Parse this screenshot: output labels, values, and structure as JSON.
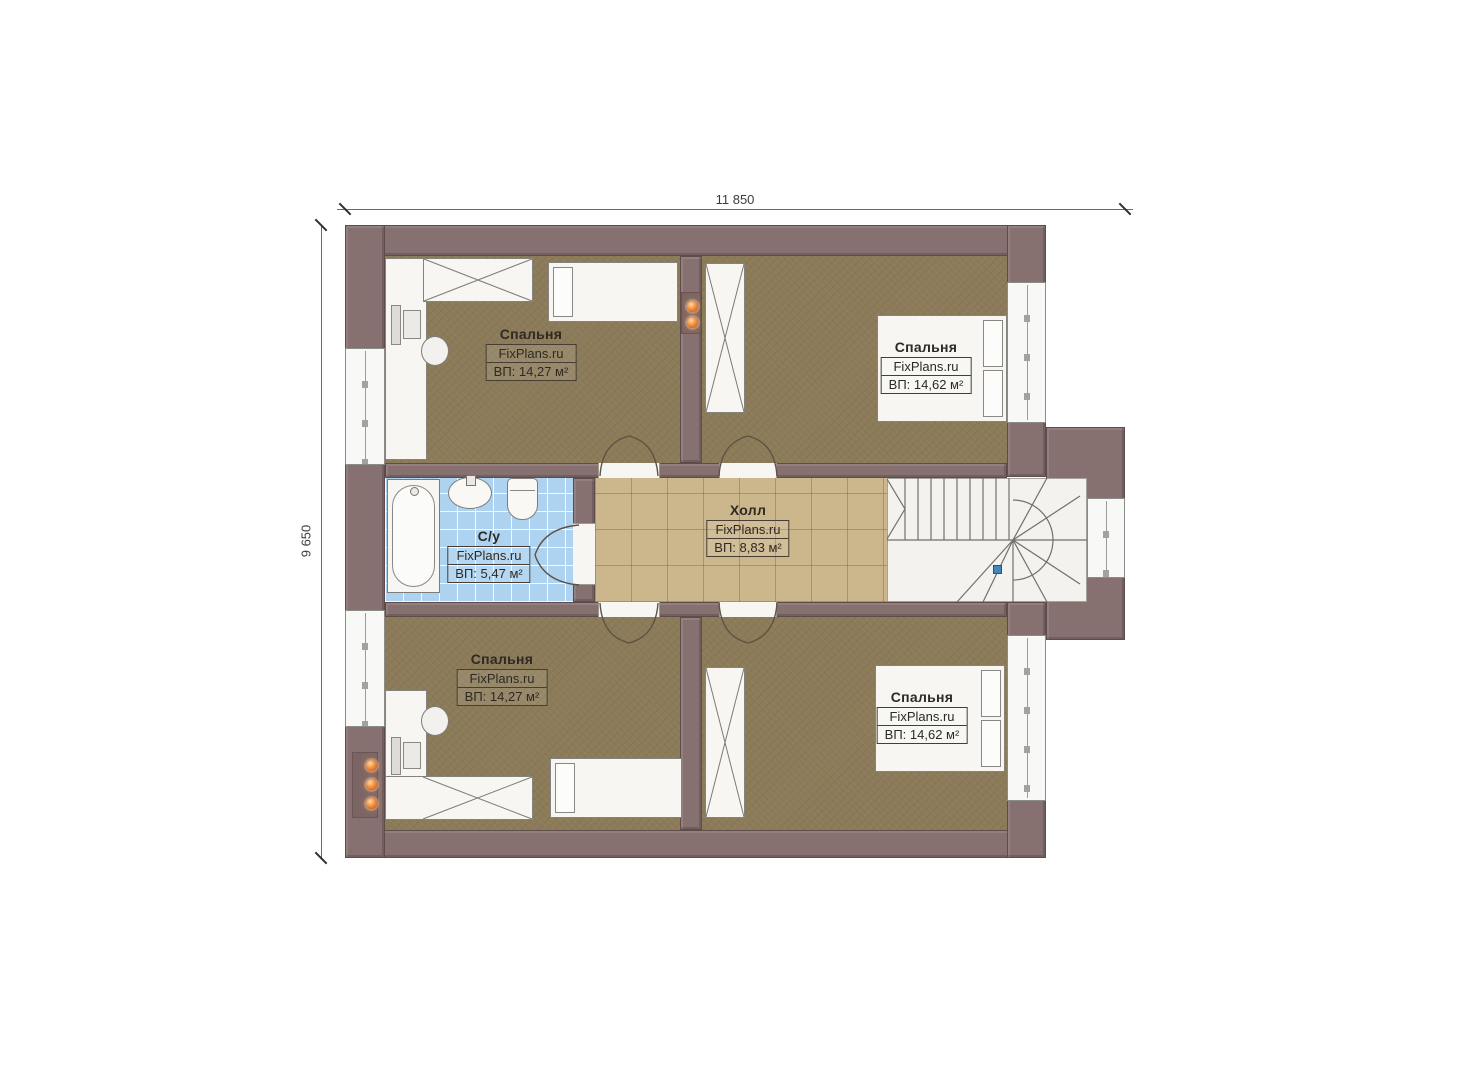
{
  "plan": {
    "title_dimensions": {
      "horizontal": "11 850",
      "vertical": "9 650"
    },
    "rooms": [
      {
        "key": "bedroom-top-left",
        "name": "Спальня",
        "brand": "FixPlans.ru",
        "area": "ВП: 14,27 м²"
      },
      {
        "key": "bedroom-top-right",
        "name": "Спальня",
        "brand": "FixPlans.ru",
        "area": "ВП: 14,62 м²"
      },
      {
        "key": "bathroom",
        "name": "С/у",
        "brand": "FixPlans.ru",
        "area": "ВП: 5,47 м²"
      },
      {
        "key": "hall",
        "name": "Холл",
        "brand": "FixPlans.ru",
        "area": "ВП: 8,83 м²"
      },
      {
        "key": "bedroom-bottom-left",
        "name": "Спальня",
        "brand": "FixPlans.ru",
        "area": "ВП: 14,27 м²"
      },
      {
        "key": "bedroom-bottom-right",
        "name": "Спальня",
        "brand": "FixPlans.ru",
        "area": "ВП: 14,62 м²"
      }
    ],
    "colors": {
      "wall": "#877170",
      "bedroom_floor": "#8c7b59",
      "hall_floor": "#ccb68c",
      "bath_floor": "#aed3f1",
      "stairs_floor": "#f3f2ef",
      "wall_light": "#f08030",
      "level_marker": "#3e88bd"
    },
    "icons": {
      "wall_light": "orange-dot",
      "level_marker": "blue-square"
    }
  }
}
